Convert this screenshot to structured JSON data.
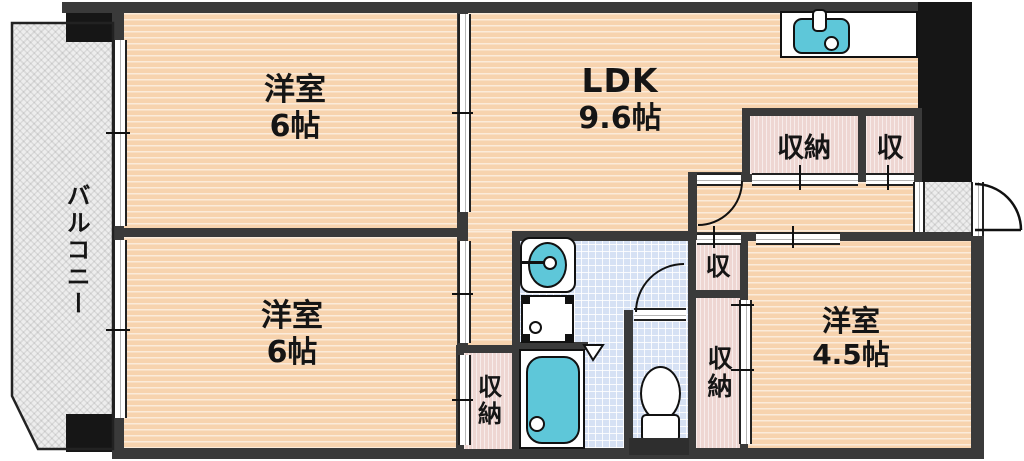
{
  "plan": {
    "balcony": {
      "label": "バルコニー"
    },
    "western_room_top": {
      "label": "洋室",
      "size": "6帖"
    },
    "western_room_bottom": {
      "label": "洋室",
      "size": "6帖"
    },
    "ldk": {
      "label": "LDK",
      "size": "9.6帖"
    },
    "western_room_right": {
      "label": "洋室",
      "size": "4.5帖"
    },
    "closet_ldk": {
      "label": "収納"
    },
    "closet_ldk_small": {
      "label": "収"
    },
    "closet_hall": {
      "label": "収"
    },
    "closet_hall_large": {
      "label": "収納"
    },
    "closet_room_bottom": {
      "label": "収納"
    }
  },
  "colors": {
    "wall": "#3a3a3a",
    "room-fill": "#f7d3ae",
    "closet-fill": "#eed6d2",
    "tile-fill": "#d6e1f4",
    "fixture-teal": "#5ec7d9",
    "balcony-fill": "#ededed",
    "outline": "#111111"
  }
}
